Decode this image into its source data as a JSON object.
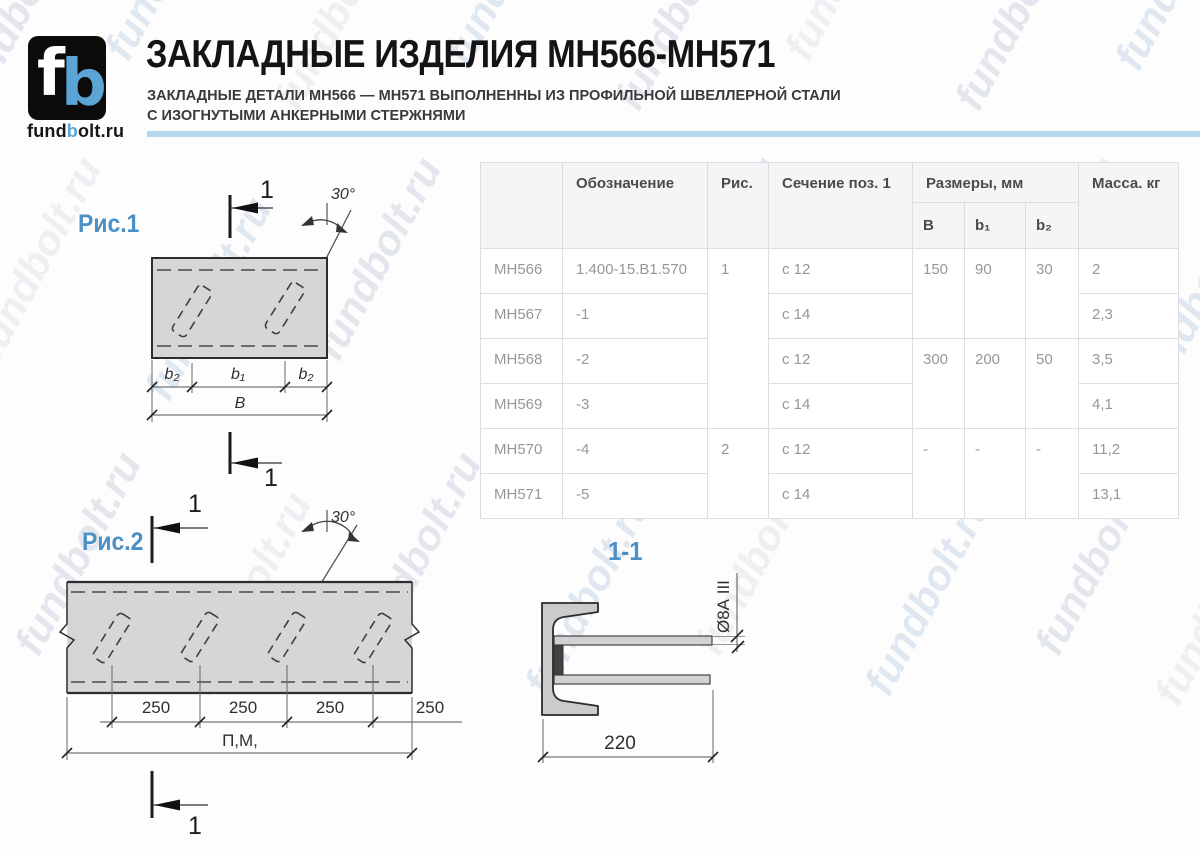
{
  "brand": {
    "logo_f": "f",
    "logo_b": "b",
    "name_part1": "fund",
    "name_part2": "b",
    "name_part3": "olt.ru"
  },
  "header": {
    "title": "ЗАКЛАДНЫЕ ИЗДЕЛИЯ МН566-МН571",
    "subtitle_line1": "ЗАКЛАДНЫЕ ДЕТАЛИ МН566 — МН571 ВЫПОЛНЕННЫ ИЗ ПРОФИЛЬНОЙ ШВЕЛЛЕРНОЙ СТАЛИ",
    "subtitle_line2": "С ИЗОГНУТЫМИ АНКЕРНЫМИ СТЕРЖНЯМИ",
    "accent_color": "#b5d8ec"
  },
  "watermark": {
    "text": "fundbolt.ru"
  },
  "figure1": {
    "label": "Рис.1",
    "section_mark": "1",
    "angle": "30°",
    "dim_b2_left": "b₂",
    "dim_b1": "b₁",
    "dim_b2_right": "b₂",
    "dim_B": "В"
  },
  "figure2": {
    "label": "Рис.2",
    "section_mark": "1",
    "angle": "30°",
    "dims": [
      "250",
      "250",
      "250",
      "250"
    ],
    "dim_total": "П,М,"
  },
  "section_view": {
    "label": "1-1",
    "rod_label": "Ø8А III",
    "dim_width": "220"
  },
  "table": {
    "headers": {
      "col_designation": "Обозначение",
      "col_fig": "Рис.",
      "col_section": "Сечение поз. 1",
      "col_sizes": "Размеры, мм",
      "col_b": "В",
      "col_b1": "b₁",
      "col_b2": "b₂",
      "col_mass": "Масса. кг"
    },
    "rows": [
      {
        "name": "МН566",
        "designation": "1.400-15.В1.570",
        "fig": "1",
        "section": "с 12",
        "b": "150",
        "b1": "90",
        "b2": "30",
        "mass": "2"
      },
      {
        "name": "МН567",
        "designation": "-1",
        "section": "с 14",
        "mass": "2,3"
      },
      {
        "name": "МН568",
        "designation": "-2",
        "section": "с 12",
        "b": "300",
        "b1": "200",
        "b2": "50",
        "mass": "3,5"
      },
      {
        "name": "МН569",
        "designation": "-3",
        "section": "с 14",
        "mass": "4,1"
      },
      {
        "name": "МН570",
        "designation": "-4",
        "fig": "2",
        "section": "с 12",
        "b": "-",
        "b1": "-",
        "b2": "-",
        "mass": "11,2"
      },
      {
        "name": "МН571",
        "designation": "-5",
        "section": "с 14",
        "mass": "13,1"
      }
    ]
  }
}
